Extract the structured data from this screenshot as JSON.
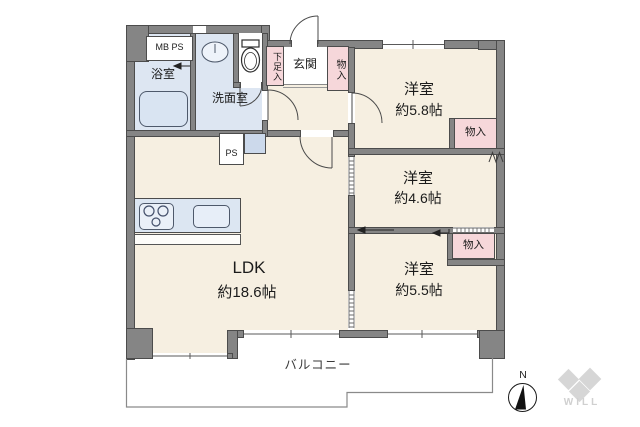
{
  "floorplan": {
    "rooms": {
      "ldk": {
        "name": "LDK",
        "size": "約18.6帖"
      },
      "bedroom1": {
        "name": "洋室",
        "size": "約5.8帖"
      },
      "bedroom2": {
        "name": "洋室",
        "size": "約4.6帖"
      },
      "bedroom3": {
        "name": "洋室",
        "size": "約5.5帖"
      },
      "bath": {
        "name": "浴室"
      },
      "washroom": {
        "name": "洗面室"
      },
      "entrance": {
        "name": "玄関"
      },
      "balcony": {
        "name": "バルコニー"
      }
    },
    "storage": {
      "shoe_cabinet": "下足入",
      "closet_hall": "物入",
      "closet_bedroom1": "物入",
      "closet_bedroom3": "物入"
    },
    "utility": {
      "mb_ps": "MB PS",
      "ps": "PS"
    },
    "compass": {
      "label": "N"
    },
    "logo": {
      "text": "WILL"
    },
    "colors": {
      "wall": "#858585",
      "room_floor": "#f6efe1",
      "wet_area": "#dde6f2",
      "storage": "#f6d7da",
      "outline": "#4c4c4c",
      "logo_gray": "#d6d6d6"
    }
  }
}
